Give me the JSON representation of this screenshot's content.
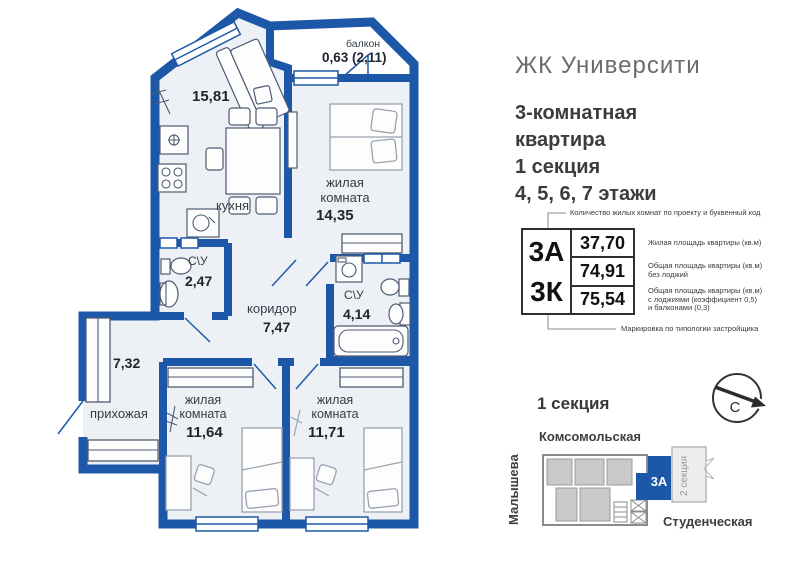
{
  "colors": {
    "wall": "#1d58a8",
    "floor": "#edf1f6",
    "furn": "#4e5b72"
  },
  "plan": {
    "balcony_label": "балкон",
    "balcony_area": "0,63 (2,11)",
    "kitchen_area": "15,81",
    "kitchen_label": "кухня",
    "living1_label": "жилая комната",
    "living1_area": "14,35",
    "bath1_label": "С\\У",
    "bath1_area": "2,47",
    "corridor_label": "коридор",
    "corridor_area": "7,47",
    "bath2_label": "С\\У",
    "bath2_area": "4,14",
    "hall_area": "7,32",
    "hall_label": "прихожая",
    "living2_label": "жилая комната",
    "living2_area": "11,64",
    "living3_label": "жилая комната",
    "living3_area": "11,71"
  },
  "panel": {
    "logo": "ЖК Университи",
    "title": [
      "3-комнатная",
      "квартира",
      "1 секция",
      "4, 5, 6, 7 этажи"
    ],
    "spec": {
      "code_top": "3А",
      "code_bottom": "3К",
      "values": [
        "37,70",
        "74,91",
        "75,54"
      ],
      "ann_top": "Количество жилых комнат по проекту и буквенный код",
      "ann_1": "Жилая площадь квартиры (кв.м)",
      "ann_2a": "Общая площадь квартиры (кв.м)",
      "ann_2b": "без лоджий",
      "ann_3a": "Общая площадь квартиры (кв.м)",
      "ann_3b": "с лоджиями (коэффициент 0,5)",
      "ann_3c": "и балконами (0,3)",
      "ann_bottom": "Маркировка по типологии застройщика"
    },
    "site": {
      "heading": "1 секция",
      "street_top": "Комсомольская",
      "street_left": "Малышева",
      "street_bottom": "Студенческая",
      "section2": "2 секция",
      "unit": "3А",
      "compass": "С"
    }
  }
}
